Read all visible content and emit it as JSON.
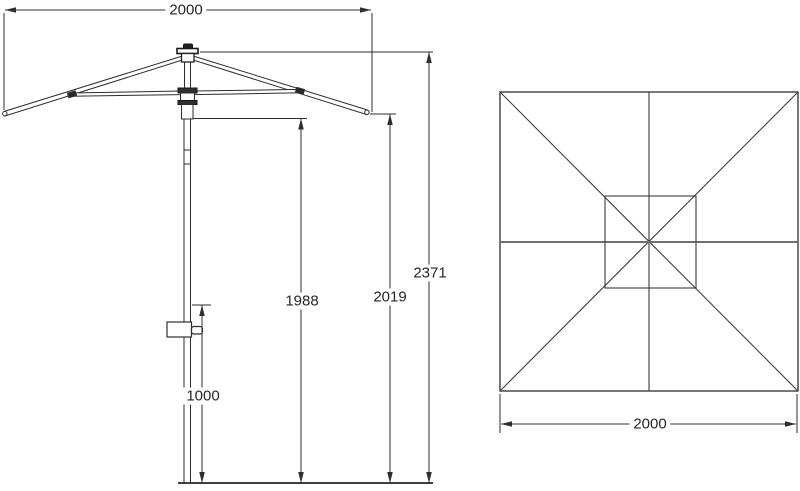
{
  "drawing_title": "parasol-dimension-drawing",
  "side_view": {
    "width_label": "2000",
    "total_height_label": "2371",
    "rib_tip_height_label": "2019",
    "canopy_clearance_label": "1988",
    "crank_height_label": "1000"
  },
  "top_view": {
    "width_label": "2000"
  },
  "colors": {
    "line": "#2e2e2e",
    "text": "#262626",
    "background": "#ffffff"
  }
}
